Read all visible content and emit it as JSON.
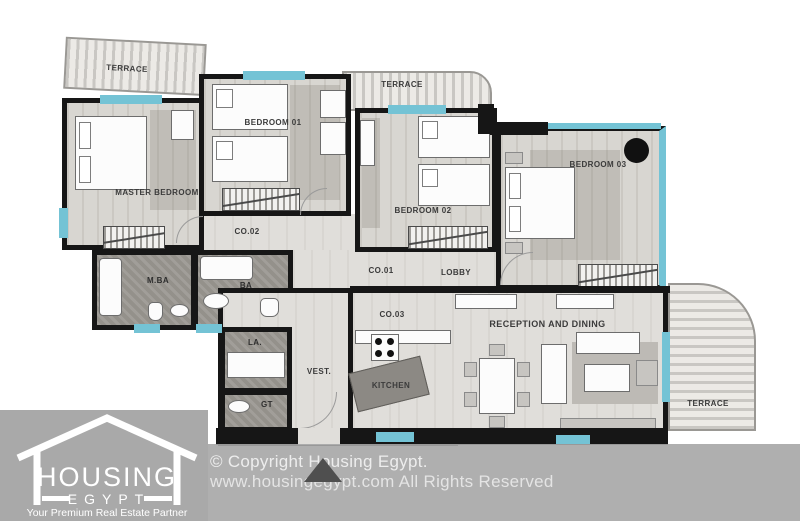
{
  "plan": {
    "rooms": {
      "terrace_top_left": "TERRACE",
      "terrace_top_mid": "TERRACE",
      "terrace_right": "TERRACE",
      "master_bedroom": "MASTER BEDROOM",
      "bedroom_01": "BEDROOM 01",
      "bedroom_02": "BEDROOM 02",
      "bedroom_03": "BEDROOM 03",
      "co_01": "CO.01",
      "co_02": "CO.02",
      "co_03": "CO.03",
      "lobby": "LOBBY",
      "master_bath": "M.BA",
      "bath": "BA",
      "laundry": "LA.",
      "guest_toilet": "GT",
      "vestibule": "VEST.",
      "kitchen": "KITCHEN",
      "reception": "RECEPTION AND DINING"
    },
    "colors": {
      "wall": "#161616",
      "window": "#74c3d5",
      "floor": "#d8d6d1",
      "bath_floor": "#94918b",
      "footer_gray": "#a9a9a9"
    }
  },
  "footer": {
    "logo": {
      "name": "HOUSING",
      "sub": "EGYPT",
      "tagline": "Your Premium Real Estate Partner"
    },
    "copyright_line1": "© Copyright Housing Egypt.",
    "copyright_line2": "www.housingegypt.com All Rights Reserved"
  }
}
